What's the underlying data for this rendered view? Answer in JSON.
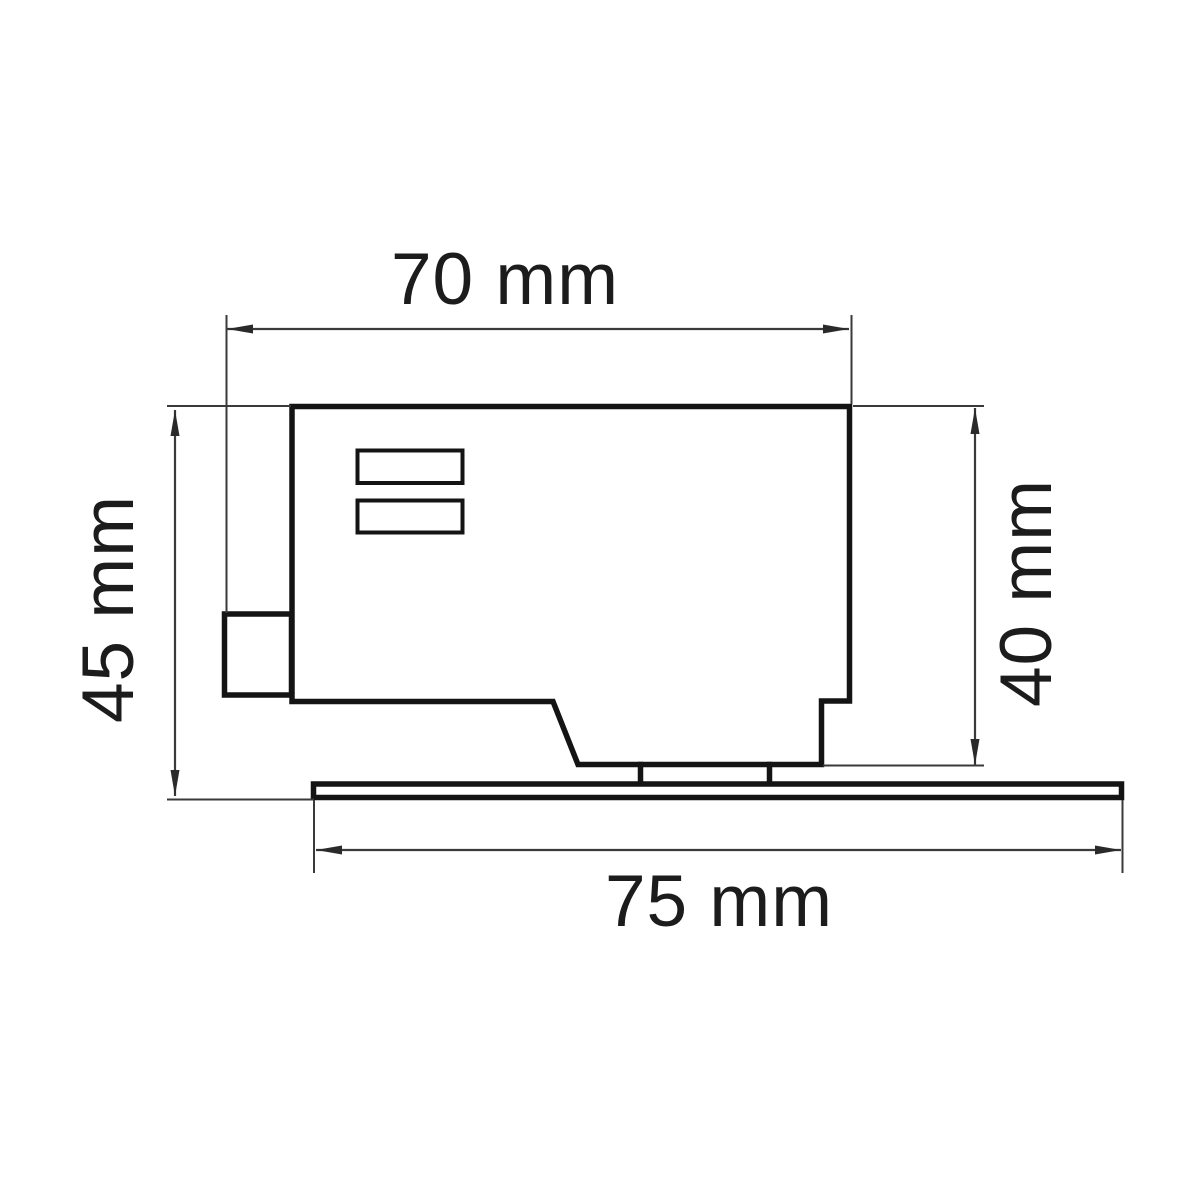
{
  "drawing": {
    "type": "technical-dimension-drawing",
    "view": "side-profile",
    "unit": "mm",
    "colors": {
      "background": "#ffffff",
      "outline": "#141414",
      "dimension_lines": "#3a3a3a",
      "text": "#1c1c1c"
    },
    "dimensions": {
      "body_width_top": {
        "label": "70 mm",
        "value": 70
      },
      "overall_height_left": {
        "label": "45 mm",
        "value": 45
      },
      "body_height_right": {
        "label": "40 mm",
        "value": 40
      },
      "base_width_bottom": {
        "label": "75 mm",
        "value": 75
      }
    }
  }
}
